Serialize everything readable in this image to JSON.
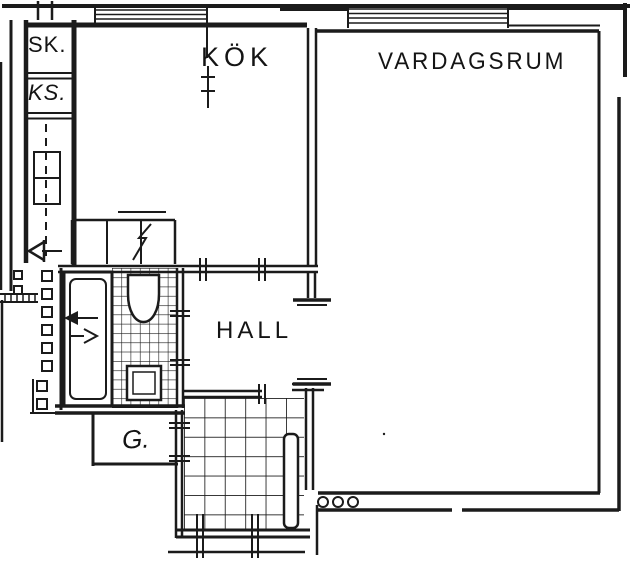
{
  "document": {
    "kind": "apartment floor plan (scanned drawing)",
    "background_color": "#ffffff",
    "line_color": "#1b1b1b"
  },
  "rooms": {
    "closet_sk": {
      "label": "SK."
    },
    "closet_ks": {
      "label": "KS."
    },
    "kitchen": {
      "label": "KÖK"
    },
    "living_room": {
      "label": "VARDAGSRUM"
    },
    "hall": {
      "label": "HALL"
    },
    "wardrobe": {
      "label": "G."
    }
  },
  "fixtures": {
    "bathtub": "bathtub-icon",
    "toilet": "toilet-icon",
    "washbasin": "washbasin-icon",
    "stove": "stove-icon",
    "kitchen_counter": "kitchen-counter-icon",
    "radiator_circles": "radiator-icon",
    "entry_door_leaf": "door-leaf-icon",
    "direction_arrows": "arrow-icons",
    "windows": "window-icon",
    "tiled_floors": "tile-grid"
  }
}
